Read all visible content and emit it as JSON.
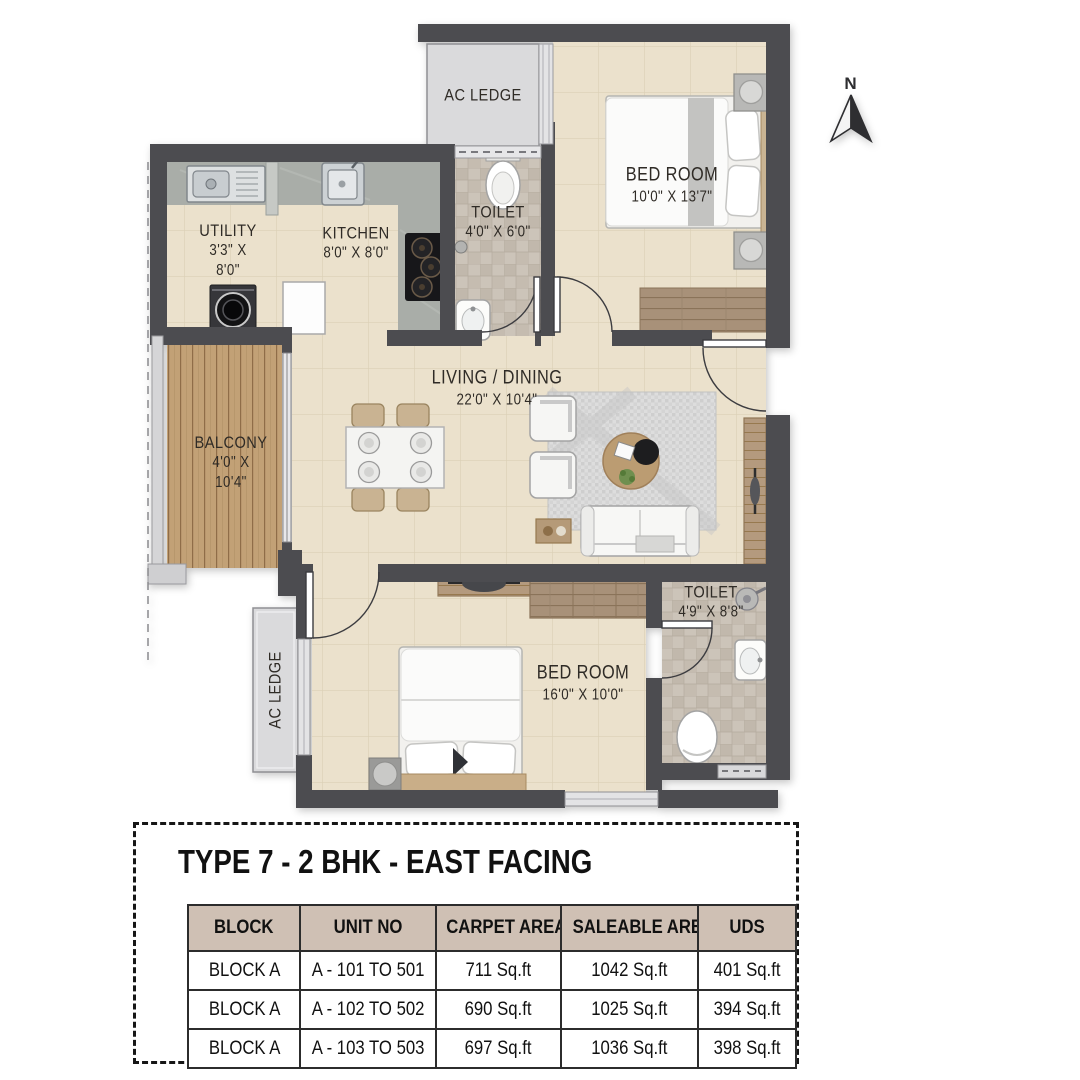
{
  "palette": {
    "wall": "#4c4c50",
    "floor": "#ebe1cc",
    "floor_line": "#dbcfb6",
    "toilet_tile": "#ccc4b9",
    "balcony_wood": "#c2a176",
    "counter": "#a9ada8",
    "ac_ledge": "#dadadc",
    "table_header_bg": "#cfc0b4",
    "text": "#2f2b26"
  },
  "compass": {
    "label": "N"
  },
  "plan": {
    "rooms": {
      "ac_ledge_top": {
        "name": "AC LEDGE"
      },
      "bedroom1": {
        "name": "BED ROOM",
        "dims": "10'0\" X 13'7\""
      },
      "toilet1": {
        "name": "TOILET",
        "dims": "4'0\" X 6'0\""
      },
      "utility": {
        "name": "UTILITY",
        "dims_line1": "3'3\" X",
        "dims_line2": "8'0\""
      },
      "kitchen": {
        "name": "KITCHEN",
        "dims": "8'0\" X 8'0\""
      },
      "living": {
        "name": "LIVING / DINING",
        "dims": "22'0\" X 10'4\""
      },
      "balcony": {
        "name": "BALCONY",
        "dims_line1": "4'0\" X",
        "dims_line2": "10'4\""
      },
      "ac_ledge_left": {
        "name": "AC LEDGE"
      },
      "bedroom2": {
        "name": "BED ROOM",
        "dims": "16'0\" X 10'0\""
      },
      "toilet2": {
        "name": "TOILET",
        "dims": "4'9\" X 8'8\""
      }
    }
  },
  "info": {
    "title": "TYPE 7 - 2 BHK - EAST FACING",
    "table": {
      "headers": [
        "BLOCK",
        "UNIT NO",
        "CARPET AREA",
        "SALEABLE AREA",
        "UDS"
      ],
      "rows": [
        [
          "BLOCK A",
          "A - 101 TO 501",
          "711 Sq.ft",
          "1042  Sq.ft",
          "401 Sq.ft"
        ],
        [
          "BLOCK A",
          "A - 102 TO 502",
          "690 Sq.ft",
          "1025 Sq.ft",
          "394 Sq.ft"
        ],
        [
          "BLOCK A",
          "A - 103 TO 503",
          "697 Sq.ft",
          "1036 Sq.ft",
          "398 Sq.ft"
        ]
      ]
    }
  }
}
